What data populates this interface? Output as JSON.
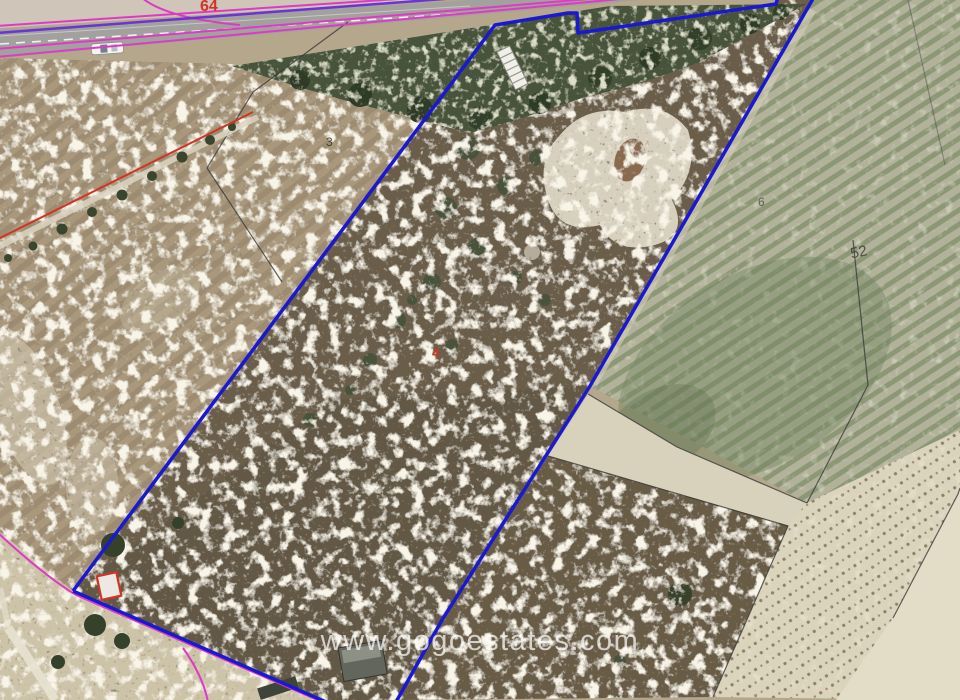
{
  "watermark": {
    "url": "www.gogoestates.com"
  },
  "labels": {
    "parcel_3": "3",
    "parcel_6": "6",
    "parcel_52": "52",
    "road_64": "64",
    "plot_4": "4"
  },
  "colors": {
    "plot_boundary": "#1a18d0",
    "magenta": "#de3bc5",
    "purple": "#6b34d4",
    "red": "#cf3526",
    "black_line": "#3a3a3a",
    "watermark_text": "#ffffff"
  }
}
